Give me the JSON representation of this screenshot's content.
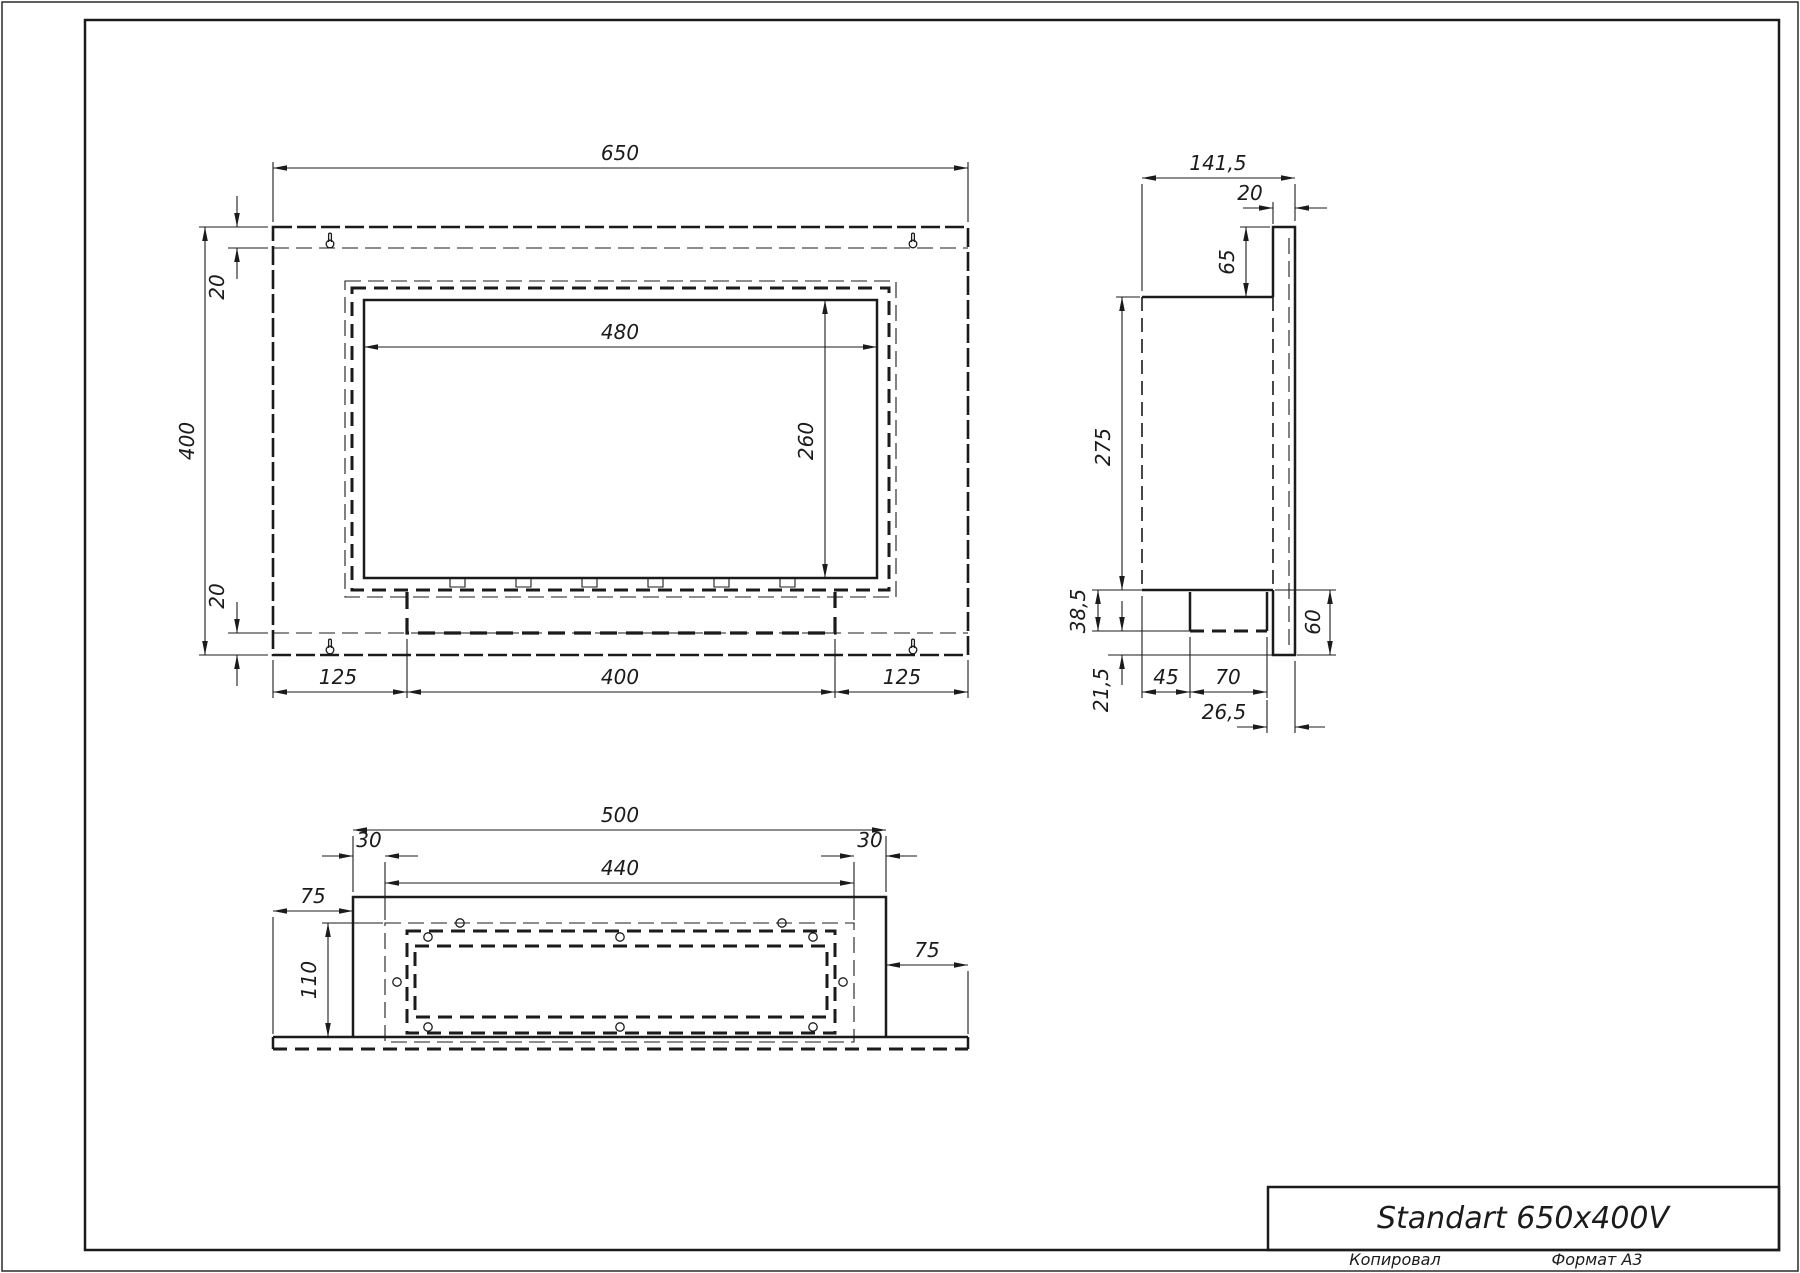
{
  "title_block": {
    "title": "Standart 650x400V"
  },
  "footer": {
    "copied": "Копировал",
    "format": "Формат A3"
  },
  "front_view": {
    "width": "650",
    "height": "400",
    "offset_top": "20",
    "offset_bottom": "20",
    "opening_width": "480",
    "opening_height": "260",
    "margin_left": "125",
    "burner_width": "400",
    "margin_right": "125"
  },
  "side_view": {
    "depth": "141,5",
    "flange_thickness": "20",
    "top_offset": "65",
    "body_height": "275",
    "tank_zone": "38,5",
    "bottom_gap": "21,5",
    "tank_left": "45",
    "tank_width": "70",
    "tank_right": "26,5",
    "bottom_height": "60"
  },
  "bottom_view": {
    "width": "500",
    "inset_left": "30",
    "inner_width": "440",
    "inset_right": "30",
    "flange_left": "75",
    "depth": "110",
    "flange_right": "75"
  }
}
